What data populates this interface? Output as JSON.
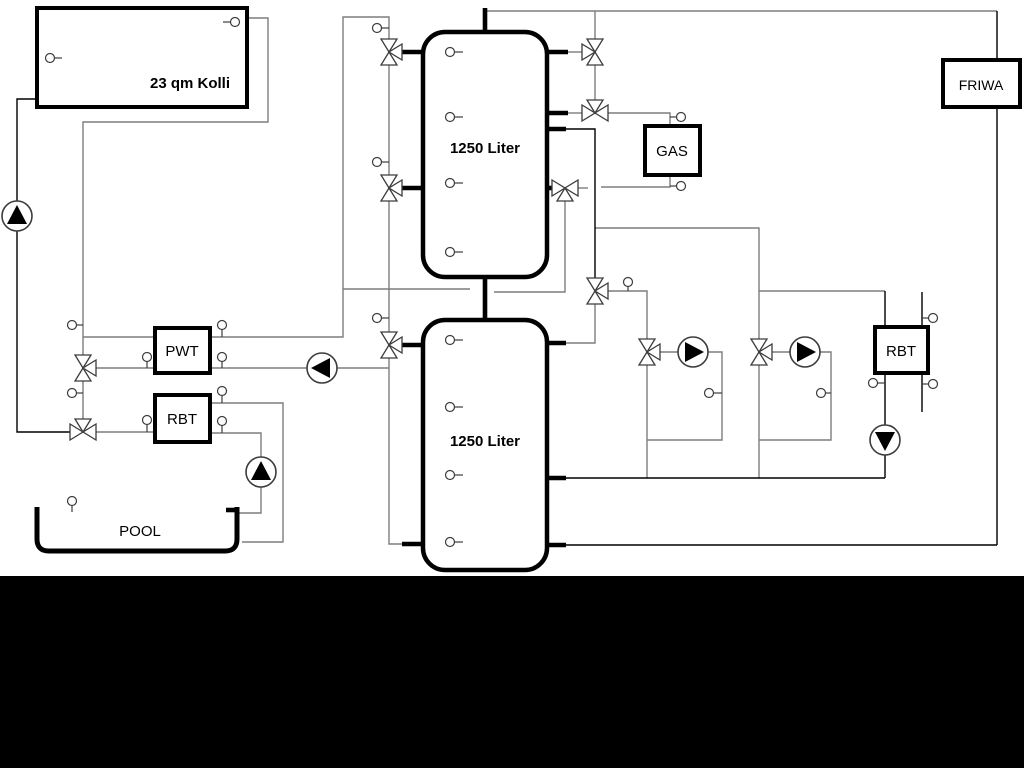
{
  "colors": {
    "background": "#ffffff",
    "pipe_gray": "#7d7d7d",
    "pipe_black": "#000000",
    "component_border": "#000000",
    "symbol_stroke": "#3c3c3c",
    "letterbox": "#000000"
  },
  "components": {
    "collector": {
      "type": "box",
      "x": 37,
      "y": 8,
      "w": 210,
      "h": 99,
      "stroke": 4,
      "label": "23 qm Kolli",
      "label_x": 190,
      "label_y": 88,
      "bold": true,
      "font": 15
    },
    "tank1": {
      "type": "tank",
      "x": 423,
      "y": 32,
      "w": 124,
      "h": 245,
      "rx": 22,
      "stroke": 4.5,
      "label": "1250 Liter",
      "label_x": 485,
      "label_y": 153,
      "bold": true,
      "font": 15
    },
    "tank2": {
      "type": "tank",
      "x": 423,
      "y": 320,
      "w": 124,
      "h": 250,
      "rx": 22,
      "stroke": 4.5,
      "label": "1250 Liter",
      "label_x": 485,
      "label_y": 446,
      "bold": true,
      "font": 15
    },
    "gas_boiler": {
      "type": "box",
      "x": 645,
      "y": 126,
      "w": 55,
      "h": 49,
      "stroke": 4,
      "label": "GAS",
      "label_x": 672,
      "label_y": 156,
      "bold": false,
      "font": 15
    },
    "pwt_heat_exchanger": {
      "type": "box",
      "x": 155,
      "y": 328,
      "w": 55,
      "h": 45,
      "stroke": 4,
      "label": "PWT",
      "label_x": 182,
      "label_y": 356,
      "bold": false,
      "font": 15
    },
    "rbt_left": {
      "type": "box",
      "x": 155,
      "y": 395,
      "w": 55,
      "h": 47,
      "stroke": 4,
      "label": "RBT",
      "label_x": 182,
      "label_y": 424,
      "bold": false,
      "font": 15
    },
    "rbt_right": {
      "type": "box",
      "x": 875,
      "y": 327,
      "w": 53,
      "h": 46,
      "stroke": 4,
      "label": "RBT",
      "label_x": 901,
      "label_y": 356,
      "bold": false,
      "font": 15
    },
    "friwa": {
      "type": "box",
      "x": 943,
      "y": 60,
      "w": 77,
      "h": 47,
      "stroke": 4,
      "label": "FRIWA",
      "label_x": 981,
      "label_y": 90,
      "bold": false,
      "font": 14
    },
    "pool": {
      "type": "pool",
      "x": 37,
      "y": 507,
      "w": 200,
      "h": 44,
      "r": 12,
      "stroke": 5,
      "label": "POOL",
      "label_x": 140,
      "label_y": 536,
      "bold": false,
      "font": 15
    }
  },
  "pipes": {
    "gray": [
      {
        "name": "top-header-pipe",
        "pts": [
          [
            485,
            11
          ],
          [
            997,
            11
          ]
        ]
      },
      {
        "name": "collector-supply-pipe",
        "pts": [
          [
            247,
            18
          ],
          [
            268,
            18
          ],
          [
            268,
            122
          ],
          [
            83,
            122
          ],
          [
            83,
            355
          ]
        ]
      },
      {
        "name": "left-column-pipe",
        "pts": [
          [
            83,
            381
          ],
          [
            83,
            419
          ]
        ]
      },
      {
        "name": "valve8-to-pwt-pipe",
        "pts": [
          [
            96,
            368
          ],
          [
            155,
            368
          ]
        ]
      },
      {
        "name": "pwt-top-feed-pipe",
        "pts": [
          [
            83,
            337
          ],
          [
            155,
            337
          ]
        ]
      },
      {
        "name": "pwt-return-riser-pipe",
        "pts": [
          [
            210,
            337
          ],
          [
            343,
            337
          ],
          [
            343,
            17
          ],
          [
            389,
            17
          ],
          [
            389,
            39
          ]
        ]
      },
      {
        "name": "tank-bridge-left-pipe",
        "pts": [
          [
            343,
            289
          ],
          [
            470,
            289
          ]
        ]
      },
      {
        "name": "solar-valve-column-1",
        "pts": [
          [
            389,
            65
          ],
          [
            389,
            175
          ]
        ]
      },
      {
        "name": "solar-valve-column-2",
        "pts": [
          [
            389,
            201
          ],
          [
            389,
            332
          ]
        ]
      },
      {
        "name": "pool-charge-column",
        "pts": [
          [
            389,
            358
          ],
          [
            389,
            544
          ],
          [
            402,
            544
          ]
        ]
      },
      {
        "name": "pwt-pump-pipe",
        "pts": [
          [
            210,
            368
          ],
          [
            389,
            368
          ]
        ]
      },
      {
        "name": "valve9-to-rbt-pipe",
        "pts": [
          [
            96,
            432
          ],
          [
            155,
            432
          ]
        ]
      },
      {
        "name": "rbt-pool-suction-pipe",
        "pts": [
          [
            210,
            403
          ],
          [
            283,
            403
          ],
          [
            283,
            542
          ],
          [
            242,
            542
          ]
        ]
      },
      {
        "name": "rbt-pool-return-pipe",
        "pts": [
          [
            210,
            433
          ],
          [
            261,
            433
          ],
          [
            261,
            513
          ],
          [
            237,
            513
          ]
        ]
      },
      {
        "name": "tank1-valve1-link",
        "pts": [
          [
            568,
            52
          ],
          [
            582,
            52
          ]
        ]
      },
      {
        "name": "tank1-valve2-link",
        "pts": [
          [
            568,
            113
          ],
          [
            582,
            113
          ]
        ]
      },
      {
        "name": "valve1-top-drop",
        "pts": [
          [
            595,
            11
          ],
          [
            595,
            39
          ]
        ]
      },
      {
        "name": "valve1-valve2-link",
        "pts": [
          [
            595,
            65
          ],
          [
            595,
            100
          ]
        ]
      },
      {
        "name": "gas-supply-pipe",
        "pts": [
          [
            608,
            113
          ],
          [
            670,
            113
          ],
          [
            670,
            126
          ]
        ]
      },
      {
        "name": "gas-return-pipe",
        "pts": [
          [
            670,
            175
          ],
          [
            670,
            187
          ],
          [
            601,
            187
          ]
        ]
      },
      {
        "name": "valve3-right-stub",
        "pts": [
          [
            578,
            188
          ],
          [
            588,
            188
          ]
        ]
      },
      {
        "name": "valve3-drop-pipe",
        "pts": [
          [
            494,
            292
          ],
          [
            565,
            292
          ],
          [
            565,
            201
          ]
        ]
      },
      {
        "name": "heating-branch-pipe",
        "pts": [
          [
            595,
            228
          ],
          [
            759,
            228
          ],
          [
            759,
            339
          ]
        ]
      },
      {
        "name": "heating-cross-pipe",
        "pts": [
          [
            759,
            291
          ],
          [
            885,
            291
          ]
        ]
      },
      {
        "name": "valve4-to-circuit1-pipe",
        "pts": [
          [
            608,
            291
          ],
          [
            647,
            291
          ],
          [
            647,
            339
          ]
        ]
      },
      {
        "name": "valve4-to-tank2-pipe",
        "pts": [
          [
            595,
            304
          ],
          [
            595,
            343
          ],
          [
            566,
            343
          ]
        ]
      },
      {
        "name": "circuit1-loop-pipe",
        "pts": [
          [
            660,
            352
          ],
          [
            722,
            352
          ],
          [
            722,
            440
          ],
          [
            647,
            440
          ]
        ]
      },
      {
        "name": "circuit1-drop-pipe",
        "pts": [
          [
            647,
            365
          ],
          [
            647,
            478
          ]
        ]
      },
      {
        "name": "circuit2-loop-pipe",
        "pts": [
          [
            772,
            352
          ],
          [
            831,
            352
          ],
          [
            831,
            440
          ],
          [
            759,
            440
          ]
        ]
      },
      {
        "name": "circuit2-drop-pipe",
        "pts": [
          [
            759,
            365
          ],
          [
            759,
            478
          ]
        ]
      }
    ],
    "black": [
      {
        "name": "collector-return-pipe",
        "pts": [
          [
            37,
            99
          ],
          [
            17,
            99
          ],
          [
            17,
            432
          ],
          [
            70,
            432
          ]
        ]
      },
      {
        "name": "tank1-heating-feed-pipe",
        "pts": [
          [
            566,
            129
          ],
          [
            595,
            129
          ],
          [
            595,
            278
          ]
        ]
      },
      {
        "name": "bottom-manifold-pipe",
        "pts": [
          [
            566,
            478
          ],
          [
            885,
            478
          ]
        ]
      },
      {
        "name": "rbt2-feed-drop",
        "pts": [
          [
            885,
            291
          ],
          [
            885,
            327
          ]
        ]
      },
      {
        "name": "rbt2-pump-pipe",
        "pts": [
          [
            885,
            373
          ],
          [
            885,
            478
          ]
        ]
      },
      {
        "name": "rbt2-side-pipe",
        "pts": [
          [
            922,
            292
          ],
          [
            922,
            412
          ]
        ]
      },
      {
        "name": "friwa-riser-pipe",
        "pts": [
          [
            997,
            11
          ],
          [
            997,
            545
          ]
        ]
      },
      {
        "name": "bottom-return-pipe",
        "pts": [
          [
            566,
            545
          ],
          [
            997,
            545
          ]
        ]
      }
    ],
    "stubs": [
      {
        "name": "tank1-top-stub",
        "pts": [
          [
            485,
            8
          ],
          [
            485,
            34
          ]
        ]
      },
      {
        "name": "tank-bridge-stub",
        "pts": [
          [
            485,
            275
          ],
          [
            485,
            322
          ]
        ]
      },
      {
        "name": "tank1-left-stub-1",
        "pts": [
          [
            402,
            52
          ],
          [
            425,
            52
          ]
        ]
      },
      {
        "name": "tank1-left-stub-2",
        "pts": [
          [
            402,
            188
          ],
          [
            425,
            188
          ]
        ]
      },
      {
        "name": "tank1-right-stub-1",
        "pts": [
          [
            545,
            52
          ],
          [
            568,
            52
          ]
        ]
      },
      {
        "name": "tank1-right-stub-2",
        "pts": [
          [
            545,
            113
          ],
          [
            568,
            113
          ]
        ]
      },
      {
        "name": "tank1-right-stub-3",
        "pts": [
          [
            545,
            129
          ],
          [
            566,
            129
          ]
        ]
      },
      {
        "name": "tank1-right-stub-4",
        "pts": [
          [
            545,
            188
          ],
          [
            553,
            188
          ]
        ]
      },
      {
        "name": "tank2-left-stub-1",
        "pts": [
          [
            402,
            345
          ],
          [
            425,
            345
          ]
        ]
      },
      {
        "name": "tank2-left-stub-2",
        "pts": [
          [
            402,
            544
          ],
          [
            425,
            544
          ]
        ]
      },
      {
        "name": "tank2-right-stub-1",
        "pts": [
          [
            545,
            343
          ],
          [
            566,
            343
          ]
        ]
      },
      {
        "name": "tank2-right-stub-2",
        "pts": [
          [
            545,
            478
          ],
          [
            566,
            478
          ]
        ]
      },
      {
        "name": "tank2-right-stub-3",
        "pts": [
          [
            545,
            545
          ],
          [
            566,
            545
          ]
        ]
      },
      {
        "name": "pool-inlet-lip",
        "pts": [
          [
            237,
            510
          ],
          [
            226,
            510
          ]
        ]
      }
    ]
  },
  "valves": [
    {
      "name": "solar-tank1-top-valve",
      "x": 389,
      "y": 52,
      "axis": "v",
      "third": "right"
    },
    {
      "name": "solar-tank1-mid-valve",
      "x": 389,
      "y": 188,
      "axis": "v",
      "third": "right"
    },
    {
      "name": "pool-charge-valve",
      "x": 389,
      "y": 345,
      "axis": "v",
      "third": "right"
    },
    {
      "name": "collector-supply-valve",
      "x": 83,
      "y": 368,
      "axis": "v",
      "third": "right"
    },
    {
      "name": "pool-return-valve",
      "x": 83,
      "y": 432,
      "axis": "h",
      "third": "top"
    },
    {
      "name": "tank1-top-right-valve",
      "x": 595,
      "y": 52,
      "axis": "v",
      "third": "left"
    },
    {
      "name": "gas-supply-valve",
      "x": 595,
      "y": 113,
      "axis": "h",
      "third": "top"
    },
    {
      "name": "gas-return-valve",
      "x": 565,
      "y": 188,
      "axis": "h",
      "third": "bottom"
    },
    {
      "name": "heating-diverter-valve",
      "x": 595,
      "y": 291,
      "axis": "v",
      "third": "right"
    },
    {
      "name": "circuit1-mixing-valve",
      "x": 647,
      "y": 352,
      "axis": "v",
      "third": "right"
    },
    {
      "name": "circuit2-mixing-valve",
      "x": 759,
      "y": 352,
      "axis": "v",
      "third": "right"
    }
  ],
  "pumps": [
    {
      "name": "collector-pump",
      "x": 17,
      "y": 216,
      "dir": "up"
    },
    {
      "name": "pwt-pump",
      "x": 322,
      "y": 368,
      "dir": "left"
    },
    {
      "name": "pool-pump",
      "x": 261,
      "y": 472,
      "dir": "up"
    },
    {
      "name": "circuit1-pump",
      "x": 693,
      "y": 352,
      "dir": "right"
    },
    {
      "name": "circuit2-pump",
      "x": 805,
      "y": 352,
      "dir": "right"
    },
    {
      "name": "rbt2-pump",
      "x": 885,
      "y": 440,
      "dir": "down"
    }
  ],
  "sensors": [
    {
      "name": "tank1-sensor-1",
      "x": 450,
      "y": 52,
      "dir": "right",
      "len": 13
    },
    {
      "name": "tank1-sensor-2",
      "x": 450,
      "y": 117,
      "dir": "right",
      "len": 13
    },
    {
      "name": "tank1-sensor-3",
      "x": 450,
      "y": 183,
      "dir": "right",
      "len": 13
    },
    {
      "name": "tank1-sensor-4",
      "x": 450,
      "y": 252,
      "dir": "right",
      "len": 13
    },
    {
      "name": "tank2-sensor-1",
      "x": 450,
      "y": 340,
      "dir": "right",
      "len": 13
    },
    {
      "name": "tank2-sensor-2",
      "x": 450,
      "y": 407,
      "dir": "right",
      "len": 13
    },
    {
      "name": "tank2-sensor-3",
      "x": 450,
      "y": 475,
      "dir": "right",
      "len": 13
    },
    {
      "name": "tank2-sensor-4",
      "x": 450,
      "y": 542,
      "dir": "right",
      "len": 13
    },
    {
      "name": "collector-sensor-left",
      "x": 50,
      "y": 58,
      "dir": "right",
      "len": 12
    },
    {
      "name": "collector-sensor-right",
      "x": 235,
      "y": 22,
      "dir": "left",
      "len": 12
    },
    {
      "name": "left-column-sensor-1",
      "x": 72,
      "y": 325,
      "dir": "right",
      "len": 11
    },
    {
      "name": "left-column-sensor-2",
      "x": 72,
      "y": 393,
      "dir": "right",
      "len": 11
    },
    {
      "name": "pwt-left-sensor",
      "x": 147,
      "y": 357,
      "dir": "down",
      "len": 11
    },
    {
      "name": "pwt-right-top-sensor",
      "x": 222,
      "y": 325,
      "dir": "down",
      "len": 12
    },
    {
      "name": "pwt-right-bottom-sensor",
      "x": 222,
      "y": 357,
      "dir": "down",
      "len": 11
    },
    {
      "name": "rbt1-left-sensor",
      "x": 147,
      "y": 420,
      "dir": "down",
      "len": 12
    },
    {
      "name": "rbt1-right-top-sensor",
      "x": 222,
      "y": 391,
      "dir": "down",
      "len": 12
    },
    {
      "name": "rbt1-right-bottom-sensor",
      "x": 222,
      "y": 421,
      "dir": "down",
      "len": 12
    },
    {
      "name": "solar-valve1-sensor",
      "x": 377,
      "y": 28,
      "dir": "right",
      "len": 12
    },
    {
      "name": "solar-valve2-sensor",
      "x": 377,
      "y": 162,
      "dir": "right",
      "len": 12
    },
    {
      "name": "pool-charge-valve-sensor",
      "x": 377,
      "y": 318,
      "dir": "right",
      "len": 12
    },
    {
      "name": "diverter-valve-sensor",
      "x": 628,
      "y": 282,
      "dir": "down",
      "len": 9
    },
    {
      "name": "gas-top-sensor",
      "x": 681,
      "y": 117,
      "dir": "left",
      "len": 11
    },
    {
      "name": "gas-bottom-sensor",
      "x": 681,
      "y": 186,
      "dir": "left",
      "len": 11
    },
    {
      "name": "circuit1-return-sensor",
      "x": 709,
      "y": 393,
      "dir": "right",
      "len": 13
    },
    {
      "name": "circuit2-return-sensor",
      "x": 821,
      "y": 393,
      "dir": "right",
      "len": 10
    },
    {
      "name": "rbt2-bottom-sensor",
      "x": 873,
      "y": 383,
      "dir": "right",
      "len": 12
    },
    {
      "name": "rbt2-side-top-sensor",
      "x": 933,
      "y": 318,
      "dir": "left",
      "len": 11
    },
    {
      "name": "rbt2-side-bottom-sensor",
      "x": 933,
      "y": 384,
      "dir": "left",
      "len": 11
    },
    {
      "name": "pool-sensor",
      "x": 72,
      "y": 501,
      "dir": "down",
      "len": 11
    }
  ],
  "letterbox": {
    "y": 576,
    "h": 192
  }
}
